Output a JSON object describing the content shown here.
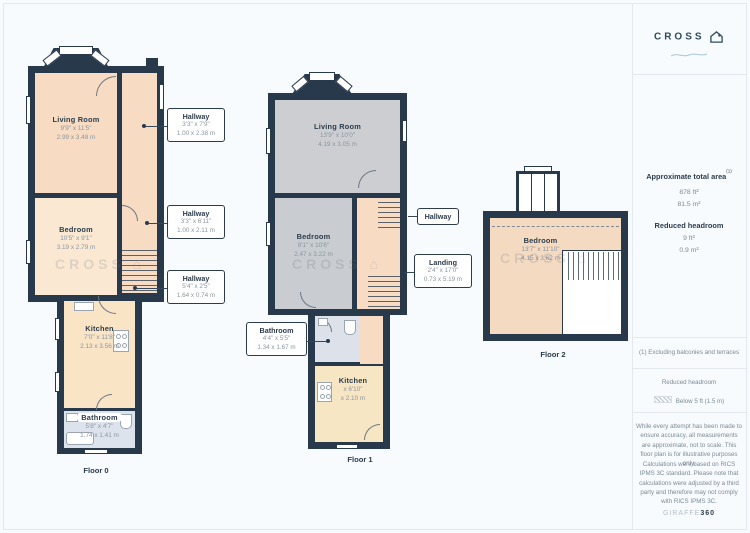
{
  "branding": {
    "logo_text": "CROSS",
    "credit_light": "GIRAFFE",
    "credit_bold": "360"
  },
  "watermark": "CROSS ⌂",
  "panel": {
    "area_title": "Approximate total area",
    "area_note_ref": "(1)",
    "area_ft": "878 ft²",
    "area_m": "81.5 m²",
    "headroom_title": "Reduced headroom",
    "headroom_ft": "9 ft²",
    "headroom_m": "0.9 m²",
    "footnote": "(1) Excluding balconies and terraces",
    "legend_title": "Reduced headroom",
    "legend_label": "Below 5 ft (1.5 m)",
    "disclaimer_1": "While every attempt has been made to ensure accuracy, all measurements are approximate, not to scale. This floor plan is for illustrative purposes only.",
    "disclaimer_2": "Calculations were based on RICS IPMS 3C standard. Please note that calculations were adjusted by a third party and therefore may not comply with RICS IPMS 3C."
  },
  "colors": {
    "wall": "#28394b",
    "room_warm": "#f7dcc3",
    "room_warm_light": "#fae8d3",
    "room_kitchen": "#f8e5c5",
    "room_grey": "#cdced1",
    "room_bath": "#dce1ea",
    "accent_text": "#2c3c4c",
    "muted_text": "#7d8a96"
  },
  "floors": [
    {
      "label": "Floor 0",
      "rooms": {
        "living": {
          "name": "Living Room",
          "ft": "9'9\" x 11'5\"",
          "m": "2.99 x 3.48 m"
        },
        "bedroom": {
          "name": "Bedroom",
          "ft": "10'5\" x 9'1\"",
          "m": "3.19 x 2.79 m"
        },
        "kitchen": {
          "name": "Kitchen",
          "ft": "7'0\" x 11'8\"",
          "m": "2.13 x 3.56 m"
        },
        "bathroom": {
          "name": "Bathroom",
          "ft": "5'8\" x 4'7\"",
          "m": "1.74 x 1.41 m"
        }
      },
      "callouts": [
        {
          "name": "Hallway",
          "ft": "3'3\" x 7'9\"",
          "m": "1.00 x 2.38 m"
        },
        {
          "name": "Hallway",
          "ft": "3'3\" x 6'11\"",
          "m": "1.00 x 2.11 m"
        },
        {
          "name": "Hallway",
          "ft": "5'4\" x 2'5\"",
          "m": "1.64 x 0.74 m"
        }
      ]
    },
    {
      "label": "Floor 1",
      "rooms": {
        "living": {
          "name": "Living Room",
          "ft": "13'9\" x 10'0\"",
          "m": "4.19 x 3.05 m"
        },
        "bedroom": {
          "name": "Bedroom",
          "ft": "8'1\" x 10'6\"",
          "m": "2.47 x 3.22 m"
        },
        "kitchen": {
          "name": "Kitchen",
          "ft": "x 6'10\"",
          "m": "x 2.10 m"
        }
      },
      "callouts": [
        {
          "name": "Hallway"
        },
        {
          "name": "Landing",
          "ft": "2'4\" x 17'0\"",
          "m": "0.73 x 5.19 m"
        },
        {
          "name": "Bathroom",
          "ft": "4'4\" x 5'5\"",
          "m": "1.34 x 1.67 m"
        }
      ]
    },
    {
      "label": "Floor 2",
      "rooms": {
        "bedroom": {
          "name": "Bedroom",
          "ft": "13'7\" x 11'10\"",
          "m": "4.15 x 3.62 m"
        }
      }
    }
  ]
}
